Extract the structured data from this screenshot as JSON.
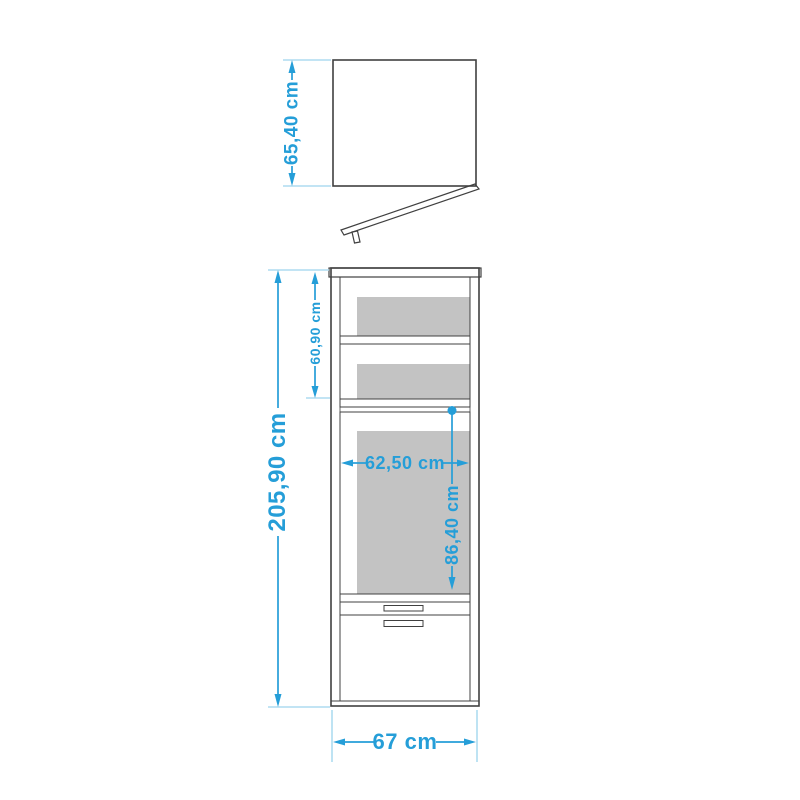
{
  "diagram": {
    "title": "wardrobe-dimension-drawing",
    "labels": {
      "top_panel_height": "65,40 cm",
      "overall_height": "205,90 cm",
      "upper_section_height": "60,90 cm",
      "interior_width": "62,50 cm",
      "interior_height": "86,40 cm",
      "overall_width": "67 cm"
    },
    "unit": "cm"
  },
  "colors": {
    "dimension_accent": "#259ED8",
    "extension_line": "#AEDCF0",
    "outline": "#404040",
    "interior_dark": "#8F8F8F",
    "interior_panel": "#C3C3C3",
    "interior_strip": "#DCDCDC",
    "front_fill": "#EDEDED",
    "panel_fill": "#E8E8E8",
    "flap_fill": "#F6F6F6",
    "handle_fill": "#C6C6C6",
    "background": "#FFFFFF"
  }
}
